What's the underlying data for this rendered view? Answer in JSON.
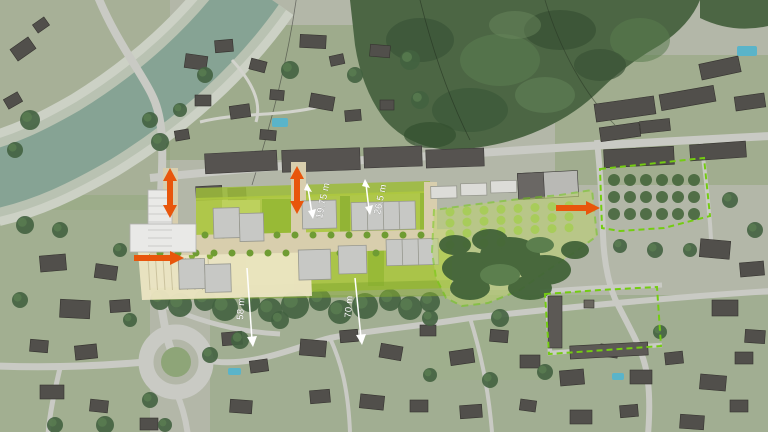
{
  "map": {
    "type": "aerial-photo-with-masterplan-overlay",
    "measurements": [
      {
        "id": "depth-west-block",
        "label": "19.75 m"
      },
      {
        "id": "depth-east-block",
        "label": "26.5 m"
      },
      {
        "id": "distance-west",
        "label": "58 m"
      },
      {
        "id": "distance-east",
        "label": "70 m"
      }
    ],
    "access_arrows": [
      {
        "name": "north-access-west",
        "direction": "vertical-double"
      },
      {
        "name": "north-access-central",
        "direction": "vertical-double"
      },
      {
        "name": "west-entry",
        "direction": "right"
      },
      {
        "name": "east-entry",
        "direction": "right"
      }
    ],
    "colors": {
      "access_orange": "#e8560c",
      "annotation_white": "#ffffff",
      "boundary_dash": "#74cc12",
      "park_fill": "#bdd36e",
      "masterplan_green": "#a8c53e",
      "spine_road_beige": "#d8cead",
      "cream_band": "#ece5c3",
      "river_water": "#86a394"
    }
  }
}
